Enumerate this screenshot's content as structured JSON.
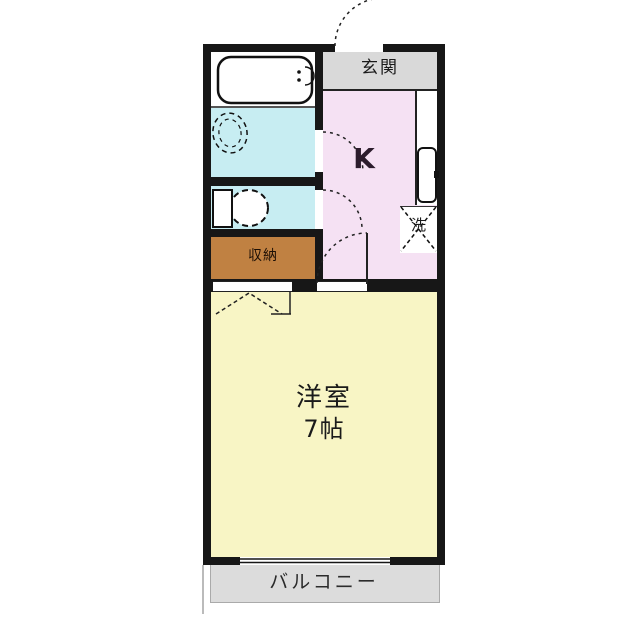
{
  "floorplan": {
    "labels": {
      "entrance": "玄関",
      "kitchen": "K",
      "washer": "洗",
      "storage": "収納",
      "room_name": "洋室",
      "room_size": "7帖",
      "balcony": "バルコニー"
    },
    "colors": {
      "wall": "#171717",
      "wet_area_floor": "#c7edf2",
      "kitchen_floor": "#f5e1f3",
      "room_floor": "#f8f5c5",
      "storage_fill": "#c08142",
      "entrance_floor": "#d9d9d9",
      "balcony_floor": "#dcdcdc"
    },
    "fixtures": [
      "bathtub",
      "wash-basin",
      "toilet",
      "kitchen-sink",
      "washing-machine-space"
    ]
  }
}
